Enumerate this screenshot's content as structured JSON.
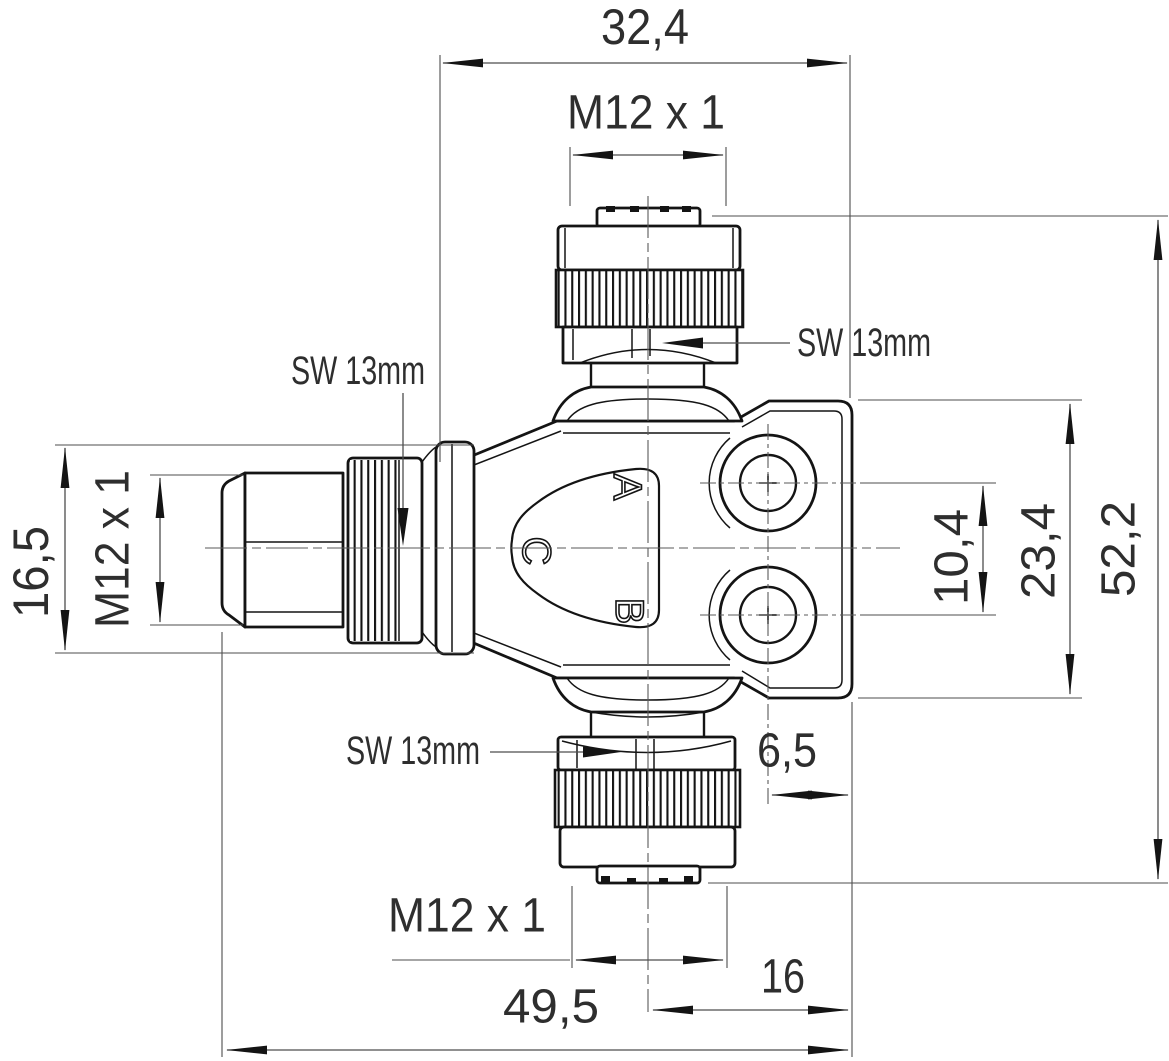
{
  "drawing": {
    "type": "technical-dimension-drawing",
    "part": "M12 twin distributor connector",
    "colors": {
      "background": "#ffffff",
      "outline": "#141414",
      "dimension": "#4d4d4d",
      "text": "#2e2e2e"
    },
    "labels": {
      "top_width": "32,4",
      "top_thread": "M12 x 1",
      "sw_top": "SW 13mm",
      "sw_left": "SW 13mm",
      "sw_bottom": "SW 13mm",
      "left_height": "16,5",
      "left_thread": "M12 x 1",
      "hole_spacing": "10,4",
      "flange_height": "23,4",
      "total_height": "52,2",
      "hole_edge_offset": "6,5",
      "bottom_thread": "M12 x 1",
      "center_to_edge": "16",
      "total_width": "49,5",
      "port_a": "A",
      "port_b": "B",
      "port_c": "C"
    }
  }
}
